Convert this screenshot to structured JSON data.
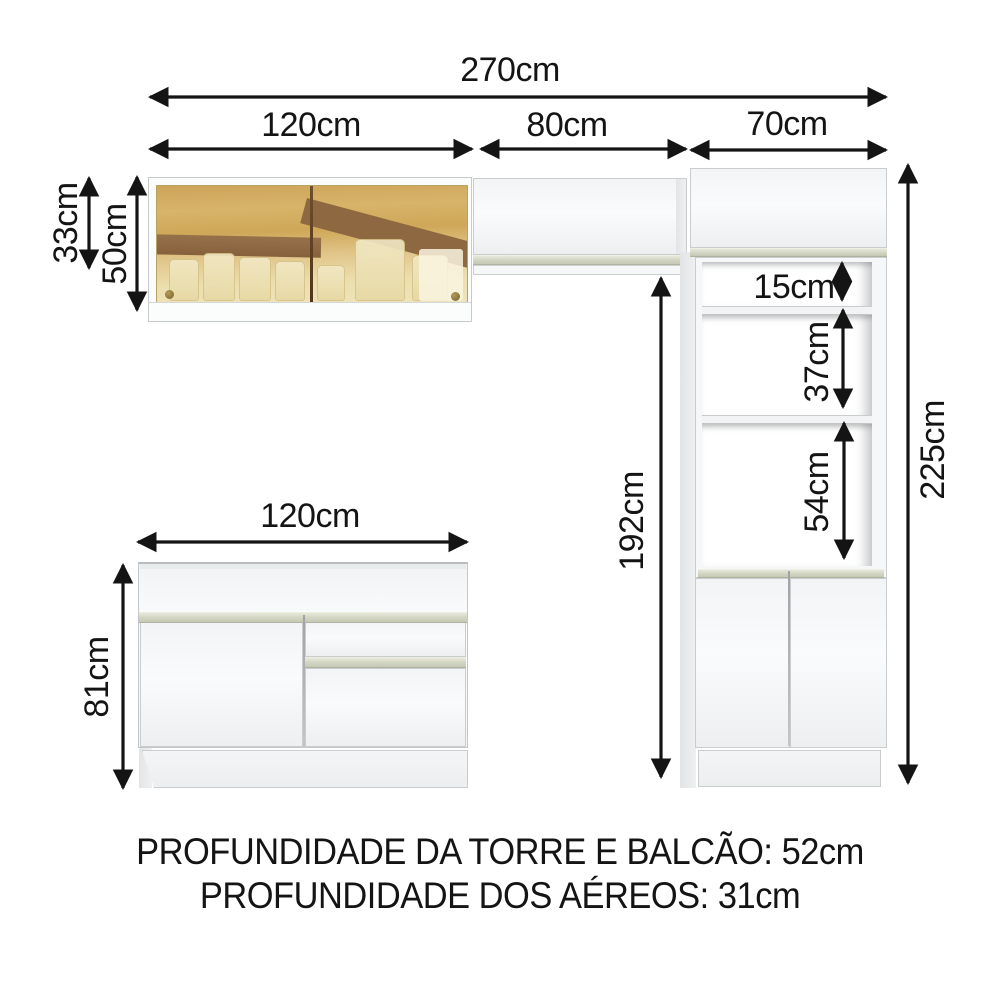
{
  "labels": {
    "total_width": "270cm",
    "glass_cabinet_width": "120cm",
    "mid_cabinet_width": "80cm",
    "tower_width": "70cm",
    "glass_door_height": "33cm",
    "glass_cabinet_height": "50cm",
    "clearance_height": "192cm",
    "tower_height": "225cm",
    "niche_top_height": "15cm",
    "niche_mid_height": "37cm",
    "niche_bottom_height": "54cm",
    "base_cabinet_height": "81cm",
    "base_cabinet_width": "120cm"
  },
  "footer": {
    "line1": "PROFUNDIDADE DA TORRE E BALCÃO: 52cm",
    "line2": "PROFUNDIDADE DOS AÉREOS: 31cm"
  },
  "colors": {
    "ink": "#141414",
    "cabinet_white": "#f7f8f9",
    "edge_gray": "#c9cdce",
    "handle_strip": "#d2d4c2",
    "glass_amber": "#d7b469",
    "glass_brown": "#8d6840",
    "background": "#ffffff"
  }
}
